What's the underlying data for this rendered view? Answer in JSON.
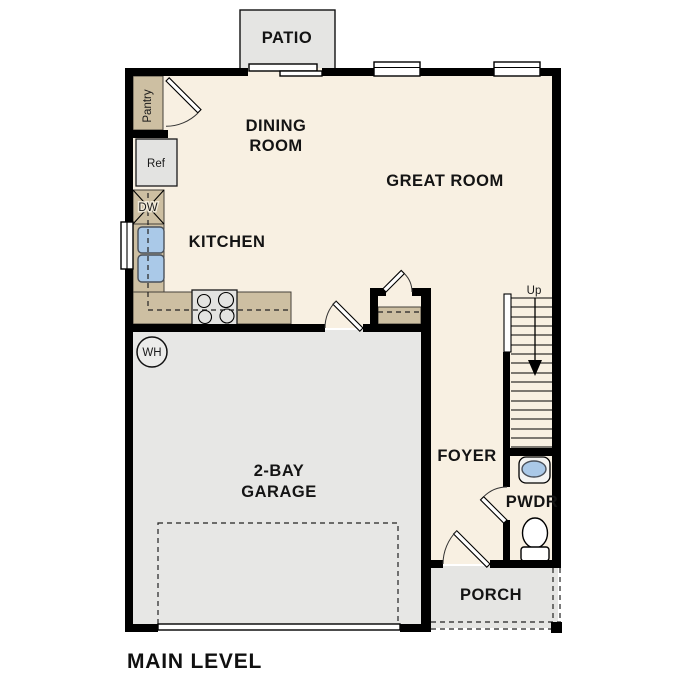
{
  "title": "MAIN LEVEL",
  "rooms": {
    "patio": "PATIO",
    "dining_line1": "DINING",
    "dining_line2": "ROOM",
    "great_room": "GREAT ROOM",
    "kitchen": "KITCHEN",
    "garage_line1": "2-BAY",
    "garage_line2": "GARAGE",
    "foyer": "FOYER",
    "pwdr": "PWDR",
    "porch": "PORCH"
  },
  "fixtures": {
    "pantry": "Pantry",
    "refrigerator": "Ref",
    "dishwasher": "DW",
    "water_heater": "WH",
    "stairs_direction": "Up"
  },
  "colors": {
    "wall_black": "#000000",
    "floor_cream": "#f8f0e2",
    "garage_gray": "#e7e7e5",
    "patio_gray": "#e5e5e3",
    "counter_tan": "#cdbfa2",
    "fixture_blue": "#aac9e8"
  }
}
